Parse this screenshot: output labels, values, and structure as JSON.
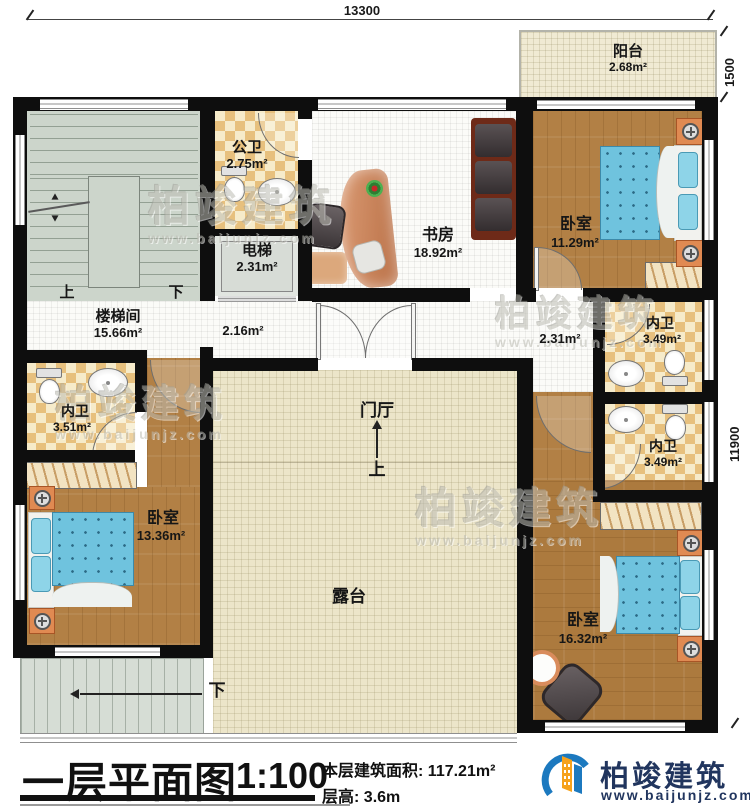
{
  "dimensions": {
    "width_total": "13300",
    "balcony_depth": "1500",
    "height_main": "11900"
  },
  "rooms": {
    "balcony": {
      "name": "阳台",
      "area": "2.68m²"
    },
    "stairwell": {
      "name": "楼梯间",
      "area": "15.66m²"
    },
    "public_bath": {
      "name": "公卫",
      "area": "2.75m²"
    },
    "elevator": {
      "name": "电梯",
      "area": "2.31m²"
    },
    "study": {
      "name": "书房",
      "area": "18.92m²"
    },
    "bedroom_ne": {
      "name": "卧室",
      "area": "11.29m²"
    },
    "hall": {
      "area": "2.16m²"
    },
    "hall_e": {
      "area": "2.31m²"
    },
    "bath_w": {
      "name": "内卫",
      "area": "3.51m²"
    },
    "bath_ne": {
      "name": "内卫",
      "area": "3.49m²"
    },
    "bath_se": {
      "name": "内卫",
      "area": "3.49m²"
    },
    "bedroom_sw": {
      "name": "卧室",
      "area": "13.36m²"
    },
    "bedroom_se": {
      "name": "卧室",
      "area": "16.32m²"
    },
    "foyer": {
      "name": "门厅"
    },
    "terrace": {
      "name": "露台"
    }
  },
  "stairs": {
    "up": "上",
    "down": "下",
    "foyer_up": "上",
    "ext_down": "下"
  },
  "titleblock": {
    "title": "一层平面图",
    "scale": "1:100",
    "area_label": "本层建筑面积:",
    "area_value": "117.21m²",
    "height_label": "层高:",
    "height_value": "3.6m"
  },
  "brand": {
    "name": "柏竣建筑",
    "website": "www.baijunjz.com"
  },
  "watermark": {
    "text": "柏竣建筑",
    "url": "www.baijunjz.com"
  },
  "colors": {
    "wall": "#0e0e0e",
    "wood": "#b28045",
    "checker": "#e7c07d",
    "cream": "#ece5c9",
    "sage": "#ccd5cb",
    "bed_blue": "#6fc3de",
    "furniture_orange": "#e08a52",
    "brand_blue": "#1c79bf",
    "brand_orange": "#f6a21c",
    "brand_navy": "#21355e"
  }
}
